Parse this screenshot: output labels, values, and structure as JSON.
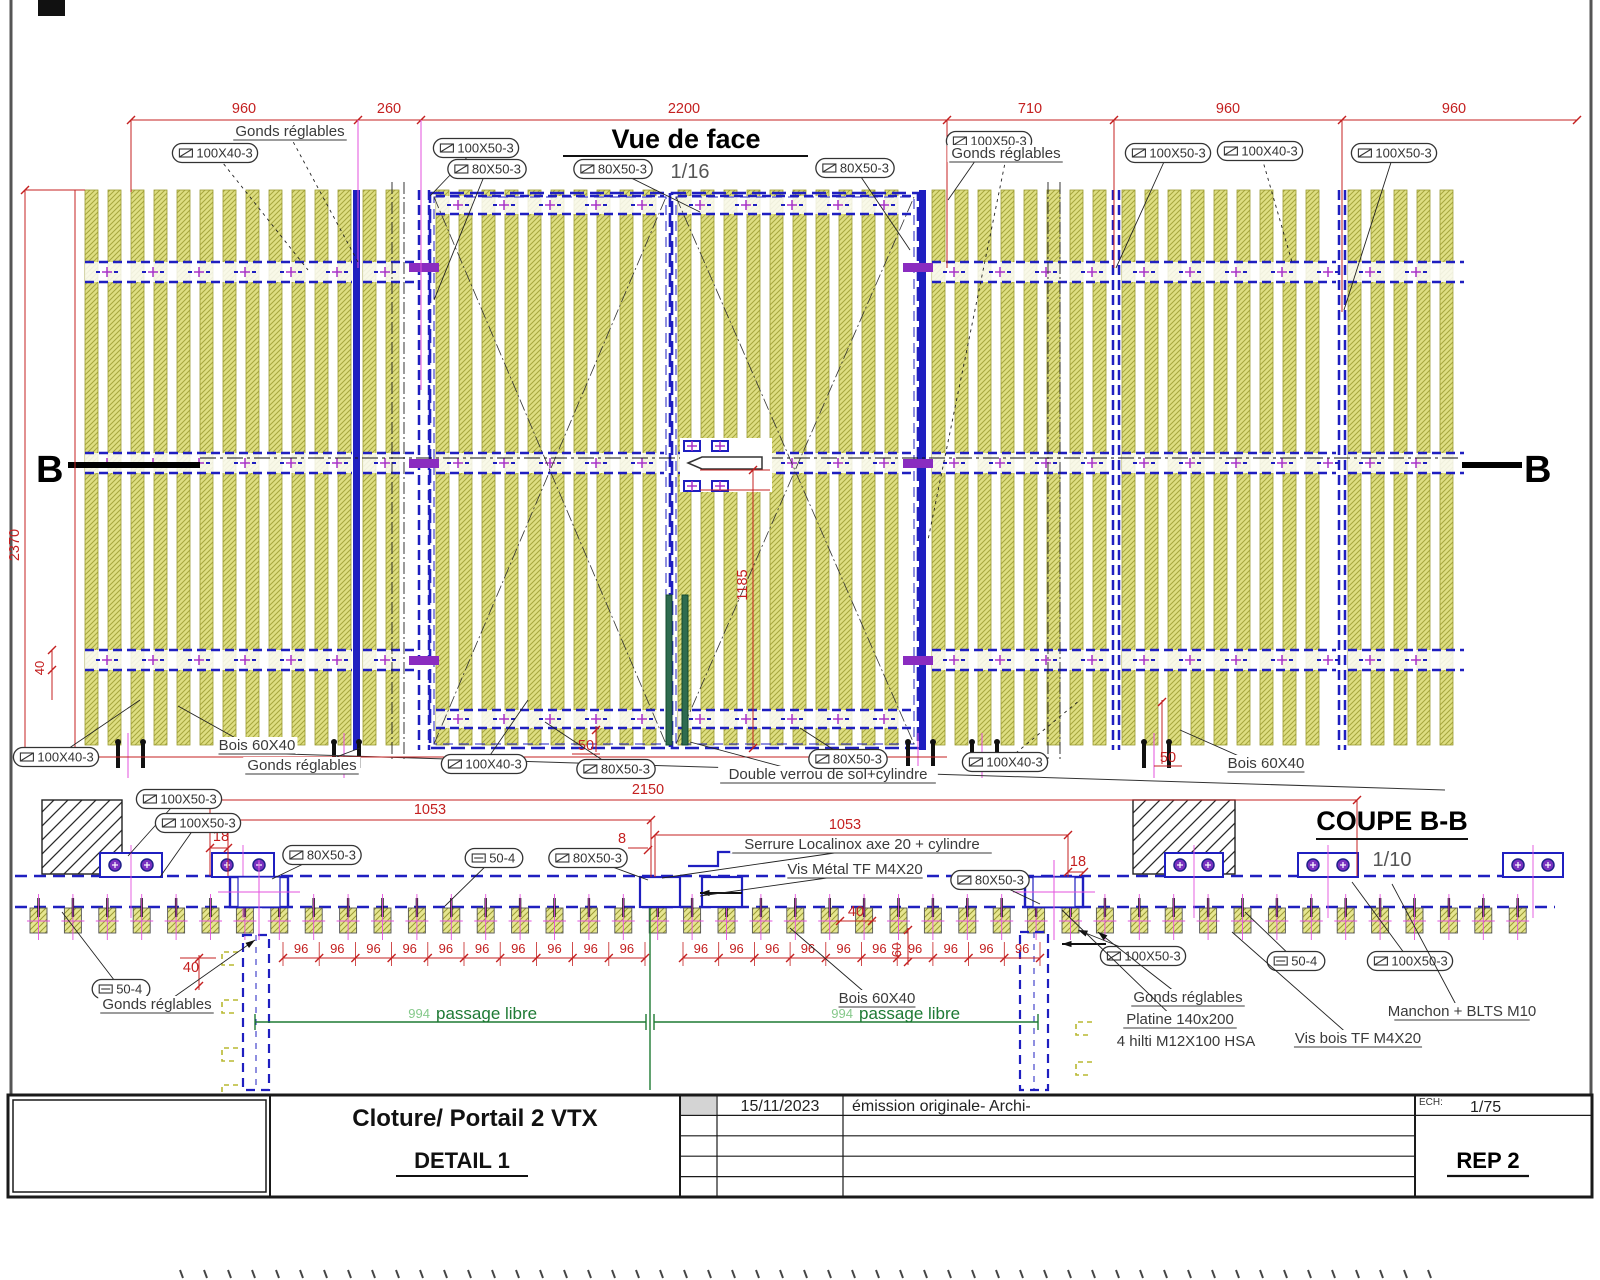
{
  "front": {
    "title": "Vue de face",
    "scale": "1/16",
    "section_marker_left": "B",
    "section_marker_right": "B",
    "top_dims": [
      "960",
      "260",
      "2200",
      "710",
      "960",
      "960"
    ],
    "dim_height": "2370",
    "dim_offset": "40",
    "dim_lock": "1185",
    "dim_50_left": "50",
    "dim_50_right": "50",
    "callouts": [
      {
        "text": "100X40-3",
        "kind": "cap",
        "x": 215,
        "y": 153,
        "lx": 308,
        "ly": 270,
        "dash": true
      },
      {
        "text": "Gonds réglables",
        "kind": "lab",
        "x": 290,
        "y": 136,
        "lx": 358,
        "ly": 262,
        "dash": true
      },
      {
        "text": "100X50-3",
        "kind": "cap",
        "x": 476,
        "y": 148,
        "lx": 430,
        "ly": 196
      },
      {
        "text": "80X50-3",
        "kind": "cap",
        "x": 487,
        "y": 169,
        "lx": 434,
        "ly": 300
      },
      {
        "text": "80X50-3",
        "kind": "cap",
        "x": 613,
        "y": 169,
        "lx": 700,
        "ly": 212
      },
      {
        "text": "80X50-3",
        "kind": "cap",
        "x": 855,
        "y": 168,
        "lx": 910,
        "ly": 250
      },
      {
        "text": "100X50-3",
        "kind": "cap",
        "x": 989,
        "y": 141,
        "lx": 948,
        "ly": 200
      },
      {
        "text": "Gonds réglables",
        "kind": "lab",
        "x": 1006,
        "y": 158,
        "lx": 928,
        "ly": 540,
        "dash": true
      },
      {
        "text": "100X50-3",
        "kind": "cap",
        "x": 1168,
        "y": 153,
        "lx": 1116,
        "ly": 268
      },
      {
        "text": "100X40-3",
        "kind": "cap",
        "x": 1260,
        "y": 151,
        "lx": 1292,
        "ly": 262,
        "dash": true
      },
      {
        "text": "100X50-3",
        "kind": "cap",
        "x": 1394,
        "y": 153,
        "lx": 1344,
        "ly": 310
      },
      {
        "text": "100X40-3",
        "kind": "cap",
        "x": 56,
        "y": 757,
        "lx": 140,
        "ly": 700
      },
      {
        "text": "Bois 60X40",
        "kind": "lab",
        "x": 257,
        "y": 750,
        "lx": 178,
        "ly": 706
      },
      {
        "text": "Gonds réglables",
        "kind": "lab",
        "x": 302,
        "y": 770,
        "lx": 360,
        "ly": 748
      },
      {
        "text": "100X40-3",
        "kind": "cap",
        "x": 484,
        "y": 764,
        "lx": 528,
        "ly": 700
      },
      {
        "text": "80X50-3",
        "kind": "cap",
        "x": 616,
        "y": 769,
        "lx": 545,
        "ly": 722
      },
      {
        "text": "Double verrou de sol+cylindre",
        "kind": "lab",
        "x": 828,
        "y": 779,
        "lx": 690,
        "ly": 742
      },
      {
        "text": "80X50-3",
        "kind": "cap",
        "x": 848,
        "y": 759,
        "lx": 800,
        "ly": 728
      },
      {
        "text": "100X40-3",
        "kind": "cap",
        "x": 1005,
        "y": 762,
        "lx": 1080,
        "ly": 700,
        "dash": true
      },
      {
        "text": "Bois 60X40",
        "kind": "lab",
        "x": 1266,
        "y": 768,
        "lx": 1180,
        "ly": 730
      }
    ]
  },
  "section": {
    "title": "COUPE B-B",
    "scale": "1/10",
    "dim_overall": "2150",
    "dim_leaf_left": "1053",
    "dim_leaf_right": "1053",
    "dim_edge_left": "18",
    "dim_gap": "8",
    "dim_edge_right": "18",
    "dim_40_center": "40",
    "dim_60": "60",
    "dim_40_left": "40",
    "dim_spacing": "96",
    "dim_passage": "994",
    "passage_label": "passage libre",
    "callouts": [
      {
        "text": "100X50-3",
        "kind": "cap",
        "x": 179,
        "y": 799,
        "lx": 128,
        "ly": 856
      },
      {
        "text": "100X50-3",
        "kind": "cap",
        "x": 198,
        "y": 823,
        "lx": 160,
        "ly": 877
      },
      {
        "text": "80X50-3",
        "kind": "cap",
        "x": 322,
        "y": 855,
        "lx": 272,
        "ly": 879
      },
      {
        "text": "50-4",
        "kind": "capf",
        "x": 494,
        "y": 858,
        "lx": 445,
        "ly": 906
      },
      {
        "text": "80X50-3",
        "kind": "cap",
        "x": 588,
        "y": 858,
        "lx": 648,
        "ly": 880
      },
      {
        "text": "80X50-3",
        "kind": "cap",
        "x": 990,
        "y": 880,
        "lx": 1040,
        "ly": 904
      },
      {
        "text": "100X50-3",
        "kind": "cap",
        "x": 1143,
        "y": 956,
        "lx": 1078,
        "ly": 930,
        "arrow": true
      },
      {
        "text": "50-4",
        "kind": "capf",
        "x": 1296,
        "y": 961,
        "lx": 1245,
        "ly": 912
      },
      {
        "text": "100X50-3",
        "kind": "cap",
        "x": 1410,
        "y": 961,
        "lx": 1352,
        "ly": 882
      },
      {
        "text": "50-4",
        "kind": "capf",
        "x": 121,
        "y": 989,
        "lx": 62,
        "ly": 912
      },
      {
        "text": "Serrure Localinox axe 20 + cylindre",
        "kind": "lab",
        "x": 862,
        "y": 849,
        "lx": 662,
        "ly": 878
      },
      {
        "text": "Vis Métal TF M4X20",
        "kind": "lab",
        "x": 855,
        "y": 874,
        "lx": 700,
        "ly": 896
      },
      {
        "text": "Gonds réglables",
        "kind": "lab",
        "x": 157,
        "y": 1009,
        "lx": 255,
        "ly": 940,
        "arrow": true
      },
      {
        "text": "Bois 60X40",
        "kind": "lab",
        "x": 877,
        "y": 1003,
        "lx": 790,
        "ly": 928
      },
      {
        "text": "Gonds réglables",
        "kind": "lab",
        "x": 1188,
        "y": 1002,
        "lx": 1098,
        "ly": 932,
        "arrow": true
      },
      {
        "text": "Platine 140x200",
        "kind": "lab",
        "x": 1180,
        "y": 1024,
        "lx": 1062,
        "ly": 910
      },
      {
        "text": "4 hilti M12X100 HSA",
        "kind": "lab2",
        "x": 1186,
        "y": 1046
      },
      {
        "text": "Vis bois TF M4X20",
        "kind": "lab",
        "x": 1358,
        "y": 1043,
        "lx": 1232,
        "ly": 932
      },
      {
        "text": "Manchon + BLTS M10",
        "kind": "lab",
        "x": 1462,
        "y": 1016,
        "lx": 1392,
        "ly": 884
      }
    ]
  },
  "title_block": {
    "project": "Cloture/ Portail 2 VTX",
    "detail": "DETAIL 1",
    "rev_date": "15/11/2023",
    "rev_desc": "émission originale- Archi-",
    "scale_label": "ECH:",
    "scale_value": "1/75",
    "rep": "REP 2"
  },
  "colors": {
    "slat": "#dede82",
    "slat_hatch": "#a6a63e",
    "frame_blue": "#1f1fc0",
    "mark_purple": "#a832c8",
    "dim_red": "#c42020",
    "passage_green": "#1e7a34",
    "magenta": "#e352dd"
  }
}
